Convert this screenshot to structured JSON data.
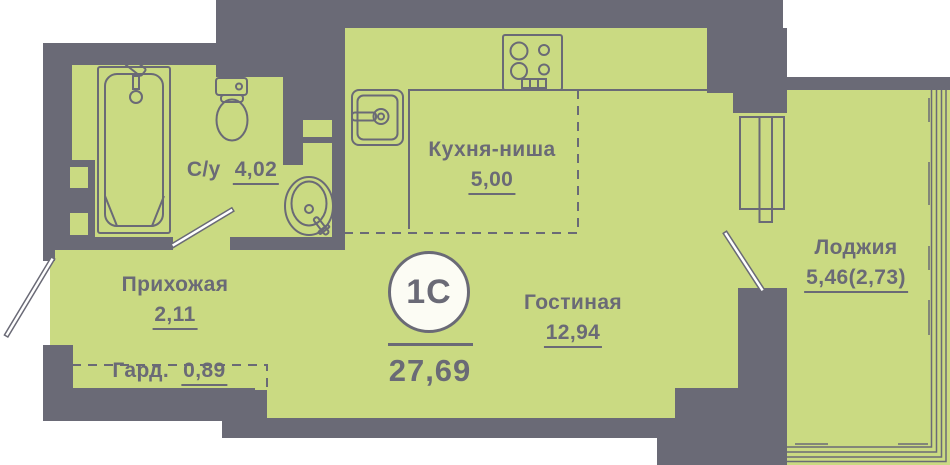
{
  "title": "Floor plan of studio apartment 1С",
  "badge": {
    "label": "1С",
    "total_area": "27,69"
  },
  "rooms": {
    "bathroom": {
      "name": "С/у",
      "area": "4,02"
    },
    "kitchen": {
      "name": "Кухня-ниша",
      "area": "5,00"
    },
    "hallway": {
      "name": "Прихожая",
      "area": "2,11"
    },
    "wardrobe": {
      "name": "Гард.",
      "area": "0,89"
    },
    "living": {
      "name": "Гостиная",
      "area": "12,94"
    },
    "loggia": {
      "name": "Лоджия",
      "area": "5,46(2,73)"
    }
  },
  "fixtures": [
    "bathtub",
    "toilet",
    "washbasin",
    "kitchen-sink",
    "stove"
  ],
  "doors": [
    "entrance-door",
    "bathroom-door",
    "loggia-door"
  ],
  "colors": {
    "background": "#ffffff",
    "wall": "#6a6a76",
    "floor": "#cada82",
    "text": "#6a6a76",
    "badge_fill": "#fcfcf4"
  }
}
